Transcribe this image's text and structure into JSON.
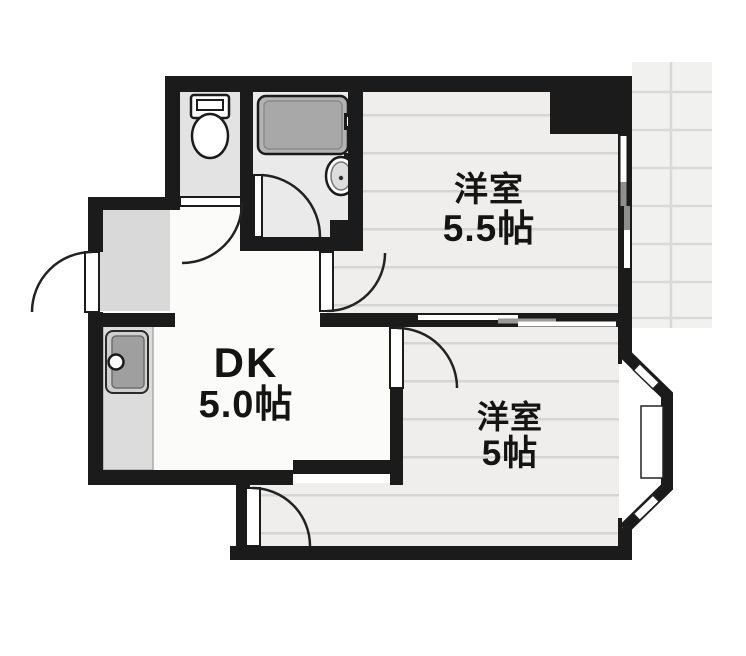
{
  "title": "apartment-floor-plan",
  "rooms": [
    {
      "id": "western-room-1",
      "name": "洋室",
      "size": "5.5帖"
    },
    {
      "id": "dining-kitchen",
      "name": "DK",
      "size": "5.0帖"
    },
    {
      "id": "western-room-2",
      "name": "洋室",
      "size": "5帖"
    }
  ],
  "fixtures": [
    "toilet",
    "bathtub",
    "bath-faucet",
    "washbasin",
    "kitchen-counter",
    "kitchen-sink",
    "entrance-genkan",
    "entrance-door",
    "toilet-door",
    "bathroom-door",
    "western-room-1-door",
    "western-room-2-door",
    "closet-door",
    "sliding-window",
    "interior-sliding-partition",
    "bay-window",
    "balcony"
  ],
  "colors": {
    "wall": "#1b1b1b",
    "room_floor": "#efeeec",
    "floor_line": "#d5d5d3",
    "tile_floor": "#dcdcdc",
    "bath_floor": "#eaeaea",
    "tub": "#b3b3b3",
    "balcony": "#f1f1ef",
    "balcony_line": "#d9d9d8",
    "white": "#ffffff"
  }
}
